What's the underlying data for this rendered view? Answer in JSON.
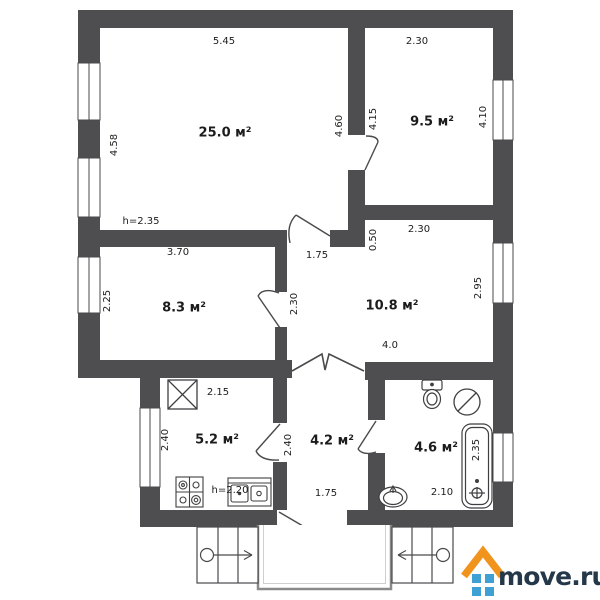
{
  "plan": {
    "type": "apartment-floor-plan",
    "watermark": {
      "text": "move.ru"
    },
    "palette": {
      "wall": "#4e4e50",
      "line": "#3f3f41",
      "text": "#1c1c1c",
      "background": "#ffffff",
      "logo_roof_orange": "#f0941d",
      "logo_window_blue": "#3fa0d4",
      "logo_text_navy": "#24384a",
      "porch_gray": "#8a8a8a"
    },
    "rooms": [
      {
        "id": "room-25-0",
        "area": "25.0 м²"
      },
      {
        "id": "room-9-5",
        "area": "9.5 м²"
      },
      {
        "id": "room-8-3",
        "area": "8.3 м²"
      },
      {
        "id": "room-10-8",
        "area": "10.8 м²"
      },
      {
        "id": "kitchen-5-2",
        "area": "5.2 м²"
      },
      {
        "id": "hall-4-2",
        "area": "4.2 м²"
      },
      {
        "id": "bathroom-4-6",
        "area": "4.6 м²"
      }
    ],
    "labels": [
      {
        "id": "dim-room25-top",
        "text": "5.45"
      },
      {
        "id": "dim-room95-top",
        "text": "2.30"
      },
      {
        "id": "dim-room25-left",
        "text": "4.58"
      },
      {
        "id": "dim-room25-right",
        "text": "4.60"
      },
      {
        "id": "dim-room95-left",
        "text": "4.15"
      },
      {
        "id": "dim-room95-right",
        "text": "4.10"
      },
      {
        "id": "ceiling-height-main",
        "text": "h=2.35"
      },
      {
        "id": "dim-room83-top",
        "text": "3.70"
      },
      {
        "id": "dim-room83-left",
        "text": "2.25"
      },
      {
        "id": "dim-room83-right",
        "text": "2.30"
      },
      {
        "id": "dim-corridor-width",
        "text": "1.75"
      },
      {
        "id": "dim-wall-stub",
        "text": "0.50"
      },
      {
        "id": "dim-room108-top",
        "text": "2.30"
      },
      {
        "id": "dim-room108-right",
        "text": "2.95"
      },
      {
        "id": "dim-room108-bottom",
        "text": "4.0"
      },
      {
        "id": "dim-kitchen-top",
        "text": "2.15"
      },
      {
        "id": "dim-kitchen-window",
        "text": "2.40"
      },
      {
        "id": "dim-hall-left",
        "text": "2.40"
      },
      {
        "id": "ceiling-height-kitchen",
        "text": "h=2.20"
      },
      {
        "id": "dim-entrance-width",
        "text": "1.75"
      },
      {
        "id": "dim-bathroom-bottom",
        "text": "2.10"
      },
      {
        "id": "dim-bathtub-length",
        "text": "2.35"
      }
    ],
    "icons": [
      "ventilation-shaft-icon",
      "stove-icon",
      "kitchen-sink-icon",
      "toilet-icon",
      "washing-machine-icon",
      "bathtub-icon",
      "wash-basin-icon",
      "entry-stairs-left-icon",
      "entry-stairs-right-icon",
      "porch-icon",
      "move-ru-house-logo-icon",
      "window-icon",
      "door-swing-icon"
    ]
  }
}
